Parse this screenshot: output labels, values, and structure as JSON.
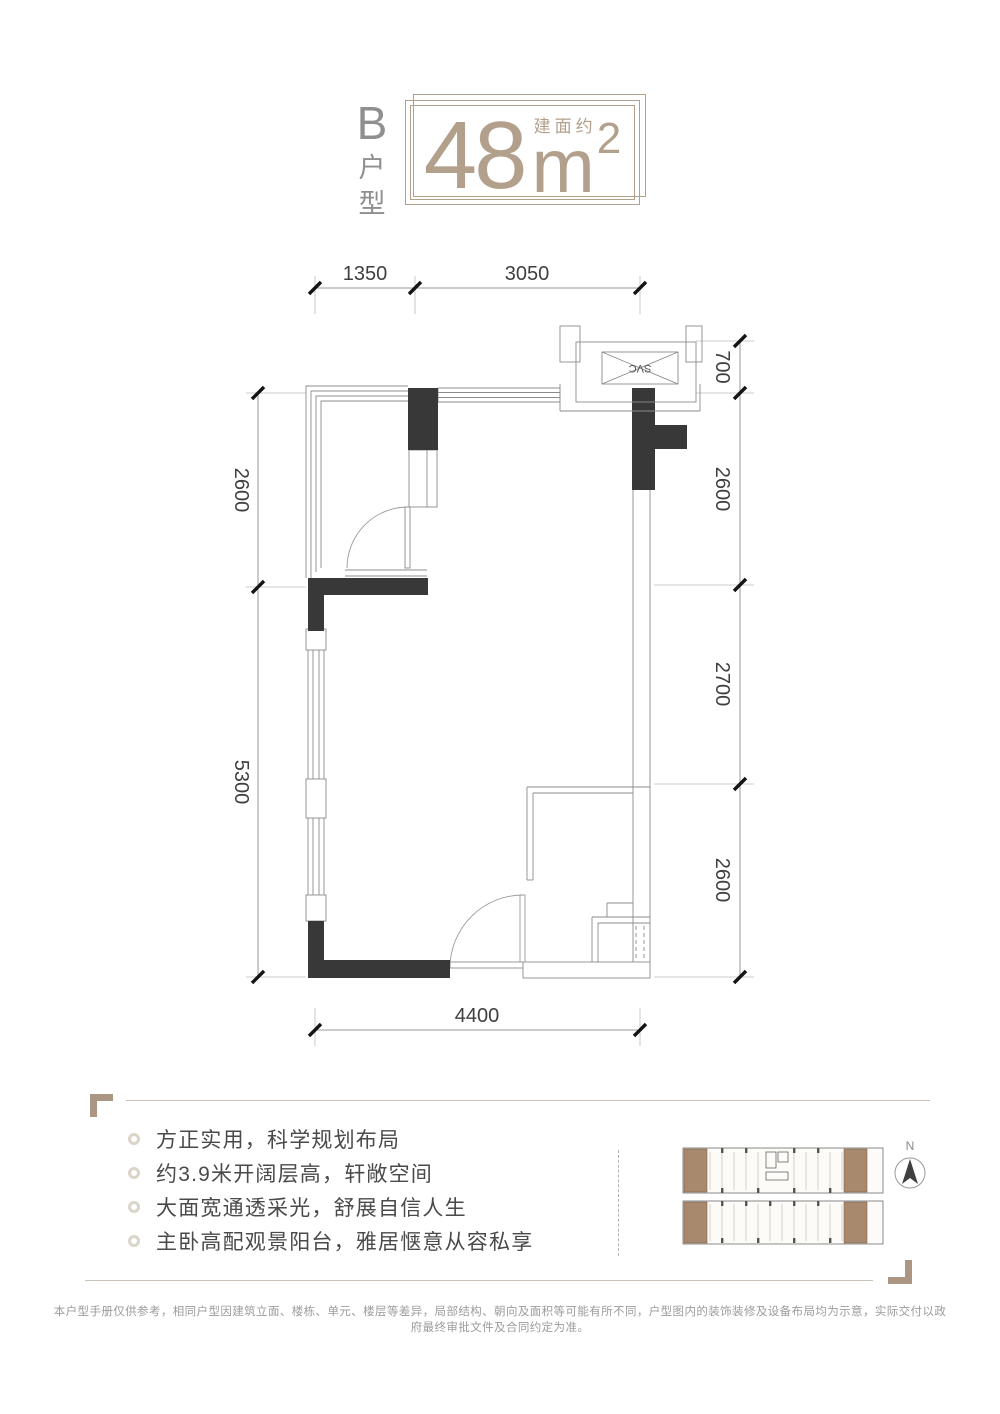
{
  "header": {
    "unit_letter": "B",
    "unit_type_char1": "户",
    "unit_type_char2": "型",
    "area_value": "48",
    "area_prefix": "建面约",
    "area_unit": "m",
    "area_exponent": "2"
  },
  "floor_plan": {
    "shaft_label": "SVC",
    "dim_top": [
      "1350",
      "3050"
    ],
    "dim_bottom": [
      "4400"
    ],
    "dim_left": [
      "2600",
      "5300"
    ],
    "dim_right": [
      "700",
      "2600",
      "2700",
      "2600"
    ]
  },
  "features": {
    "items": [
      "方正实用，科学规划布局",
      "约3.9米开阔层高，轩敞空间",
      "大面宽通透采光，舒展自信人生",
      "主卧高配观景阳台，雅居惬意从容私享"
    ]
  },
  "key_plan": {
    "north_label": "N"
  },
  "footer": {
    "disclaimer": "本户型手册仅供参考，相同户型因建筑立面、楼栋、单元、楼层等差异，局部结构、朝向及面积等可能有所不同，户型图内的装饰装修及设备布局均为示意，实际交付以政府最终审批文件及合同约定为准。"
  },
  "colors": {
    "accent": "#b3a08c",
    "wall": "#383838",
    "corner_ornament": "#ab9683",
    "keyplan_unit": "#a8896e",
    "text_dark": "#4a4a4a",
    "text_muted": "#9c9c9c"
  }
}
